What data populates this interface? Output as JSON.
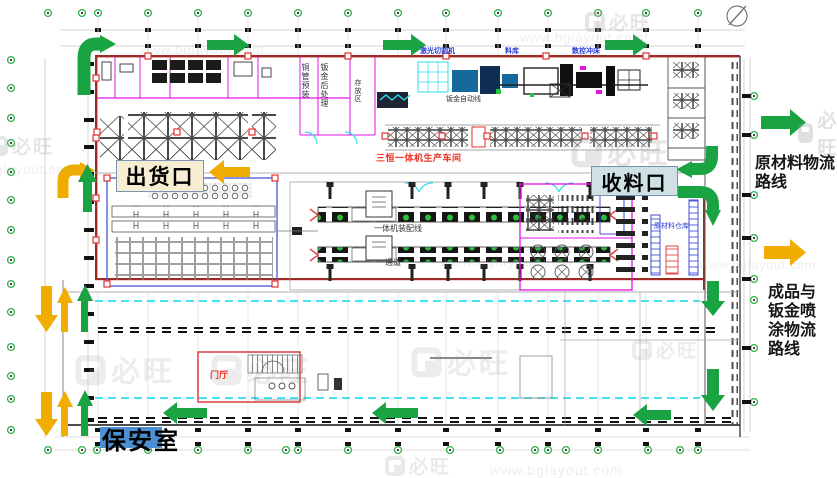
{
  "title": "工厂物流路线平面图",
  "colors": {
    "green": "#19A343",
    "yellow": "#F0AD00",
    "wall_red": "#9E2B23",
    "magenta": "#E513E5",
    "cyan": "#2BDCEF",
    "blue": "#2A3BD6",
    "red_text": "#F03022",
    "label_shipping_bg": "#F7EDD3",
    "label_receiving_bg": "#CFE1E4",
    "label_security_bg": "#4A90D2"
  },
  "labels": {
    "shipping_gate": "出货口",
    "receiving_gate": "收料口",
    "security_room": "保安室",
    "route_raw_material": "原材料物流\n路线",
    "route_finished": "成品与\n钣金喷\n涂物流\n路线",
    "workshop_line": "三恒一体机生产车间",
    "assembly_line": "一体机装配线",
    "aisle": "通道",
    "copper_preassembly": "铜管预装",
    "sheetmetal_post_process": "钣金后处理",
    "storage_area": "存放区",
    "sheetmetal_auto_line": "钣金自动线",
    "laser_cutting": "激光切割机",
    "material_store": "料库",
    "cnc_punch": "数控冲床",
    "raw_material_warehouse": "原材料仓库",
    "lobby": "门厅"
  },
  "watermark": {
    "url_text": "www.bglayout.com",
    "brand": "必旺"
  }
}
